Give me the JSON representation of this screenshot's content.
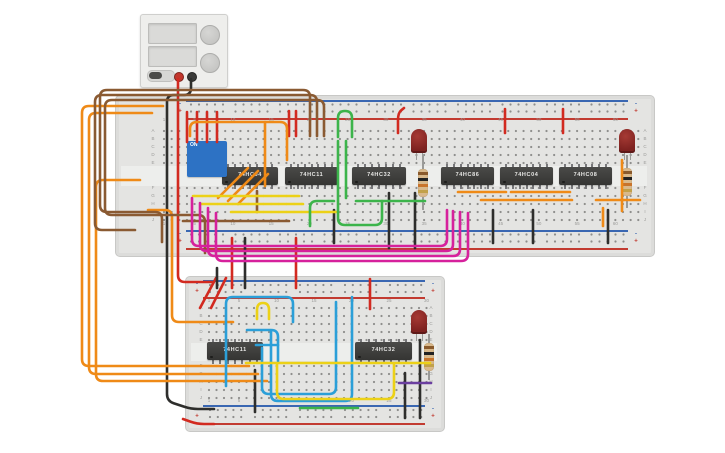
{
  "canvas": {
    "w": 725,
    "h": 453,
    "bg": "#ffffff"
  },
  "palette": {
    "red": "#d22a20",
    "black": "#2e2e2c",
    "orange": "#ef8a17",
    "brown": "#8a5a32",
    "yellow": "#ecd117",
    "green": "#3cb44b",
    "magenta": "#d6219c",
    "cyan": "#2b9fd8",
    "purple": "#6b3fa0",
    "board": "#e4e4e2",
    "hole": "#8e8e8c",
    "label": "#9b9b99",
    "rail_red": "#c23b31",
    "rail_blue": "#3a67b2",
    "ic_body": "#3f3f3d",
    "led_red": "#8f2422",
    "resistor_body": "#d9b98c",
    "resistor_bands": [
      "#8a5a2c",
      "#222222",
      "#c8742c",
      "#c2a14a"
    ]
  },
  "power_supply": {
    "terminal_plus": "+",
    "terminal_minus": "-"
  },
  "boards": [
    {
      "id": "breadboard-large",
      "x": 115,
      "y": 95,
      "w": 538,
      "h": 160,
      "gap_y": 166,
      "gap_h": 20,
      "col_labels": [
        "1",
        "5",
        "10",
        "15",
        "20",
        "25",
        "30",
        "35",
        "40",
        "45",
        "50",
        "55",
        "60"
      ],
      "col1_x": 164,
      "col_spacing": 7.65,
      "cols": 63,
      "row_letters_top": [
        "A",
        "B",
        "C",
        "D",
        "E"
      ],
      "rows_top_y": 131,
      "row_letters_bottom": [
        "F",
        "G",
        "H",
        "I",
        "J"
      ],
      "rows_bottom_y": 188,
      "row_spacing": 8,
      "letter_x_left": 153,
      "letter_x_right": 645,
      "num_y_top": 120,
      "num_y_bottom": 224,
      "rails": [
        {
          "blue_y": 100,
          "rows_y": [
            104.5,
            111.5
          ],
          "red_y": 118,
          "x1": 186,
          "x2": 628,
          "hole_x1": 191,
          "clusters": 10,
          "pitch": 44.5,
          "step": 8
        },
        {
          "blue_y": 230,
          "rows_y": [
            234.5,
            241.5
          ],
          "red_y": 248,
          "x1": 186,
          "x2": 628,
          "hole_x1": 191,
          "clusters": 10,
          "pitch": 44.5,
          "step": 8
        }
      ]
    },
    {
      "id": "breadboard-small",
      "x": 185,
      "y": 276,
      "w": 258,
      "h": 154,
      "gap_y": 343,
      "gap_h": 18,
      "col_labels": [
        "1",
        "5",
        "10",
        "15",
        "20",
        "25",
        "30"
      ],
      "col1_x": 209,
      "col_spacing": 7.5,
      "cols": 30,
      "row_letters_top": [
        "A",
        "B",
        "C",
        "D",
        "E"
      ],
      "rows_top_y": 308,
      "row_letters_bottom": [
        "F",
        "G",
        "H",
        "I",
        "J"
      ],
      "rows_bottom_y": 366,
      "row_spacing": 8,
      "letter_x_left": 201,
      "letter_x_right": 431,
      "num_y_top": 301,
      "num_y_bottom": 401,
      "rails": [
        {
          "blue_y": 280,
          "rows_y": [
            285,
            292
          ],
          "red_y": 297,
          "x1": 203,
          "x2": 425,
          "hole_x1": 210,
          "clusters": 5,
          "pitch": 45,
          "step": 7.8
        },
        {
          "blue_y": 405,
          "rows_y": [
            410,
            417
          ],
          "red_y": 423,
          "x1": 203,
          "x2": 425,
          "hole_x1": 210,
          "clusters": 5,
          "pitch": 45,
          "step": 7.8
        }
      ]
    }
  ],
  "ics": [
    {
      "label": "74HC04",
      "x": 222,
      "y": 167,
      "w": 56
    },
    {
      "label": "74HC11",
      "x": 285,
      "y": 167,
      "w": 53
    },
    {
      "label": "74HC32",
      "x": 352,
      "y": 167,
      "w": 54
    },
    {
      "label": "74HC86",
      "x": 441,
      "y": 167,
      "w": 53
    },
    {
      "label": "74HC04",
      "x": 500,
      "y": 167,
      "w": 53
    },
    {
      "label": "74HC08",
      "x": 559,
      "y": 167,
      "w": 53
    },
    {
      "label": "74HC11",
      "x": 207,
      "y": 342,
      "w": 56
    },
    {
      "label": "74HC32",
      "x": 355,
      "y": 342,
      "w": 57
    }
  ],
  "leds": [
    {
      "x": 411,
      "y": 129
    },
    {
      "x": 619,
      "y": 129
    },
    {
      "x": 411,
      "y": 310
    }
  ],
  "resistors": [
    {
      "cx": 423,
      "y1": 155,
      "y2": 210
    },
    {
      "cx": 627,
      "y1": 155,
      "y2": 208
    },
    {
      "cx": 429,
      "y1": 334,
      "y2": 380
    }
  ],
  "dip_switch": {
    "x": 187,
    "y": 141,
    "w": 40,
    "h": 36,
    "title": "ON",
    "numbers": [
      "1",
      "2",
      "3",
      "4"
    ],
    "states": [
      false,
      false,
      false,
      false
    ]
  },
  "wires": [
    {
      "c": "red",
      "p": [
        [
          178,
          79
        ],
        [
          178,
          282
        ],
        [
          212,
          282
        ]
      ]
    },
    {
      "c": "red",
      "p": [
        [
          187,
          112
        ],
        [
          187,
          142
        ]
      ]
    },
    {
      "c": "red",
      "p": [
        [
          197,
          112
        ],
        [
          197,
          142
        ]
      ]
    },
    {
      "c": "red",
      "p": [
        [
          207,
          112
        ],
        [
          207,
          142
        ]
      ]
    },
    {
      "c": "red",
      "p": [
        [
          217,
          112
        ],
        [
          217,
          142
        ]
      ]
    },
    {
      "c": "red",
      "p": [
        [
          289,
          111
        ],
        [
          289,
          136
        ]
      ]
    },
    {
      "c": "red",
      "p": [
        [
          296,
          111
        ],
        [
          296,
          136
        ]
      ]
    },
    {
      "c": "red",
      "p": [
        [
          404,
          108
        ],
        [
          398,
          113
        ],
        [
          398,
          133
        ]
      ]
    },
    {
      "c": "red",
      "p": [
        [
          505,
          109
        ],
        [
          505,
          133
        ]
      ]
    },
    {
      "c": "red",
      "p": [
        [
          563,
          109
        ],
        [
          563,
          133
        ]
      ]
    },
    {
      "c": "red",
      "p": [
        [
          232,
          238
        ],
        [
          232,
          288
        ]
      ]
    },
    {
      "c": "red",
      "p": [
        [
          296,
          238
        ],
        [
          296,
          288
        ]
      ]
    },
    {
      "c": "red",
      "p": [
        [
          216,
          278
        ],
        [
          200,
          308
        ]
      ]
    },
    {
      "c": "red",
      "p": [
        [
          226,
          278
        ],
        [
          211,
          308
        ]
      ]
    },
    {
      "c": "red",
      "p": [
        [
          370,
          279
        ],
        [
          370,
          309
        ]
      ]
    },
    {
      "c": "red",
      "p": [
        [
          183,
          419
        ],
        [
          197,
          424
        ],
        [
          214,
          424
        ]
      ]
    },
    {
      "c": "black",
      "p": [
        [
          191,
          79
        ],
        [
          191,
          95
        ],
        [
          167,
          95
        ],
        [
          167,
          401
        ],
        [
          191,
          409
        ],
        [
          214,
          409
        ]
      ]
    },
    {
      "c": "black",
      "p": [
        [
          245,
          238
        ],
        [
          245,
          288
        ]
      ]
    },
    {
      "c": "black",
      "p": [
        [
          217,
          268
        ],
        [
          217,
          288
        ]
      ]
    },
    {
      "c": "black",
      "p": [
        [
          334,
          210
        ],
        [
          334,
          243
        ]
      ]
    },
    {
      "c": "black",
      "p": [
        [
          389,
          193
        ],
        [
          389,
          248
        ]
      ]
    },
    {
      "c": "black",
      "p": [
        [
          415,
          193
        ],
        [
          415,
          248
        ]
      ]
    },
    {
      "c": "black",
      "p": [
        [
          493,
          210
        ],
        [
          493,
          243
        ]
      ]
    },
    {
      "c": "black",
      "p": [
        [
          533,
          210
        ],
        [
          533,
          243
        ]
      ]
    },
    {
      "c": "black",
      "p": [
        [
          608,
          210
        ],
        [
          608,
          243
        ]
      ]
    },
    {
      "c": "black",
      "p": [
        [
          255,
          370
        ],
        [
          255,
          412
        ]
      ]
    },
    {
      "c": "black",
      "p": [
        [
          405,
          373
        ],
        [
          405,
          418
        ]
      ]
    },
    {
      "c": "black",
      "p": [
        [
          420,
          340
        ],
        [
          420,
          418
        ]
      ]
    },
    {
      "c": "orange",
      "p": [
        [
          163,
          106
        ],
        [
          82,
          106
        ],
        [
          82,
          366
        ],
        [
          249,
          366
        ]
      ]
    },
    {
      "c": "orange",
      "p": [
        [
          152,
          113
        ],
        [
          89,
          113
        ],
        [
          89,
          374
        ],
        [
          258,
          374
        ]
      ]
    },
    {
      "c": "orange",
      "p": [
        [
          140,
          180
        ],
        [
          96,
          180
        ],
        [
          96,
          381
        ],
        [
          267,
          381
        ]
      ]
    },
    {
      "c": "orange",
      "p": [
        [
          148,
          210
        ],
        [
          172,
          210
        ],
        [
          172,
          322
        ],
        [
          233,
          322
        ]
      ]
    },
    {
      "c": "orange",
      "p": [
        [
          190,
          136
        ],
        [
          190,
          122
        ],
        [
          287,
          122
        ],
        [
          287,
          160
        ]
      ]
    },
    {
      "c": "orange",
      "p": [
        [
          265,
          122
        ],
        [
          265,
          186
        ]
      ]
    },
    {
      "c": "orange",
      "p": [
        [
          218,
          198
        ],
        [
          248,
          168
        ]
      ]
    },
    {
      "c": "orange",
      "p": [
        [
          228,
          201
        ],
        [
          258,
          171
        ]
      ]
    },
    {
      "c": "orange",
      "p": [
        [
          238,
          204
        ],
        [
          268,
          174
        ]
      ]
    },
    {
      "c": "orange",
      "p": [
        [
          458,
          192
        ],
        [
          506,
          192
        ]
      ]
    },
    {
      "c": "orange",
      "p": [
        [
          511,
          192
        ],
        [
          570,
          192
        ]
      ]
    },
    {
      "c": "orange",
      "p": [
        [
          481,
          200
        ],
        [
          572,
          200
        ]
      ]
    },
    {
      "c": "orange",
      "p": [
        [
          622,
          160
        ],
        [
          622,
          211
        ]
      ]
    },
    {
      "c": "orange",
      "p": [
        [
          596,
          200
        ],
        [
          640,
          200
        ]
      ]
    },
    {
      "c": "orange",
      "p": [
        [
          603,
          208
        ],
        [
          603,
          226
        ]
      ]
    },
    {
      "c": "brown",
      "p": [
        [
          310,
          136
        ],
        [
          310,
          90
        ],
        [
          100,
          90
        ],
        [
          100,
          212
        ],
        [
          162,
          212
        ],
        [
          162,
          242
        ]
      ]
    },
    {
      "c": "brown",
      "p": [
        [
          317,
          136
        ],
        [
          317,
          95
        ],
        [
          95,
          95
        ],
        [
          95,
          230
        ],
        [
          135,
          230
        ]
      ]
    },
    {
      "c": "brown",
      "p": [
        [
          324,
          136
        ],
        [
          324,
          100
        ],
        [
          105,
          100
        ],
        [
          105,
          215
        ],
        [
          205,
          215
        ],
        [
          205,
          253
        ]
      ]
    },
    {
      "c": "brown",
      "p": [
        [
          183,
          221
        ],
        [
          289,
          221
        ]
      ]
    },
    {
      "c": "brown",
      "p": [
        [
          257,
          191
        ],
        [
          257,
          212
        ]
      ]
    },
    {
      "c": "yellow",
      "p": [
        [
          193,
          196
        ],
        [
          299,
          196
        ]
      ]
    },
    {
      "c": "yellow",
      "p": [
        [
          201,
          204
        ],
        [
          303,
          204
        ]
      ]
    },
    {
      "c": "yellow",
      "p": [
        [
          231,
          212
        ],
        [
          338,
          212
        ]
      ]
    },
    {
      "c": "green",
      "p": [
        [
          338,
          137
        ],
        [
          338,
          111
        ],
        [
          352,
          111
        ],
        [
          352,
          137
        ]
      ]
    },
    {
      "c": "green",
      "p": [
        [
          338,
          141
        ],
        [
          338,
          225
        ],
        [
          382,
          225
        ],
        [
          382,
          201
        ]
      ]
    },
    {
      "c": "green",
      "p": [
        [
          346,
          141
        ],
        [
          346,
          198
        ]
      ]
    },
    {
      "c": "green",
      "p": [
        [
          310,
          226
        ],
        [
          310,
          201
        ],
        [
          334,
          201
        ]
      ]
    },
    {
      "c": "green",
      "p": [
        [
          356,
          201
        ],
        [
          425,
          201
        ]
      ]
    },
    {
      "c": "green",
      "p": [
        [
          300,
          408
        ],
        [
          358,
          408
        ]
      ]
    },
    {
      "c": "magenta",
      "p": [
        [
          192,
          198
        ],
        [
          192,
          246
        ],
        [
          447,
          246
        ],
        [
          447,
          210
        ]
      ]
    },
    {
      "c": "magenta",
      "p": [
        [
          200,
          203
        ],
        [
          200,
          251
        ],
        [
          453,
          251
        ],
        [
          453,
          211
        ]
      ]
    },
    {
      "c": "magenta",
      "p": [
        [
          208,
          208
        ],
        [
          208,
          256
        ],
        [
          460,
          256
        ],
        [
          460,
          212
        ]
      ]
    },
    {
      "c": "magenta",
      "p": [
        [
          216,
          213
        ],
        [
          216,
          261
        ],
        [
          468,
          261
        ],
        [
          468,
          213
        ]
      ]
    },
    {
      "c": "cyan",
      "p": [
        [
          226,
          386
        ],
        [
          226,
          297
        ],
        [
          293,
          297
        ],
        [
          293,
          322
        ]
      ]
    },
    {
      "c": "cyan",
      "p": [
        [
          247,
          330
        ],
        [
          278,
          330
        ],
        [
          278,
          361
        ]
      ]
    },
    {
      "c": "cyan",
      "p": [
        [
          256,
          345
        ],
        [
          278,
          345
        ]
      ]
    },
    {
      "c": "cyan",
      "p": [
        [
          262,
          348
        ],
        [
          262,
          394
        ],
        [
          336,
          394
        ],
        [
          336,
          302
        ]
      ]
    },
    {
      "c": "cyan",
      "p": [
        [
          271,
          331
        ],
        [
          271,
          401
        ],
        [
          352,
          401
        ],
        [
          352,
          297
        ]
      ]
    },
    {
      "c": "yellow",
      "p": [
        [
          257,
          319
        ],
        [
          257,
          303
        ],
        [
          269,
          303
        ],
        [
          269,
          319
        ]
      ]
    },
    {
      "c": "yellow",
      "p": [
        [
          246,
          363
        ],
        [
          430,
          363
        ]
      ]
    },
    {
      "c": "yellow",
      "p": [
        [
          277,
          364
        ],
        [
          277,
          399
        ],
        [
          394,
          399
        ],
        [
          394,
          364
        ]
      ]
    },
    {
      "c": "purple",
      "p": [
        [
          399,
          383
        ],
        [
          431,
          383
        ]
      ]
    }
  ]
}
